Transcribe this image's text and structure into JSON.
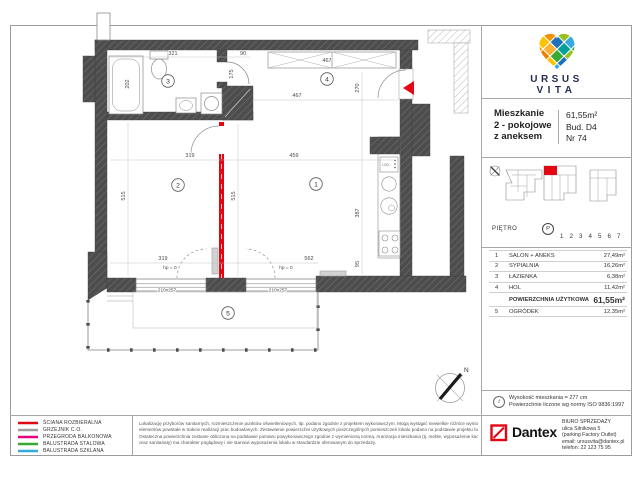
{
  "brand": {
    "line1": "URSUS",
    "line2": "VITA",
    "heart_warm": [
      "#f9b233",
      "#f39200",
      "#ef7d00",
      "#fdc300"
    ],
    "heart_cool": [
      "#95c11f",
      "#3aaa35",
      "#00a19a",
      "#36a9e1",
      "#1d71b8"
    ]
  },
  "header": {
    "title1": "Mieszkanie",
    "title2": "2 - pokojowe",
    "title3": "z aneksem",
    "area": "61,55m²",
    "building": "Bud. D4",
    "number": "Nr 74"
  },
  "floor_selector": {
    "label": "PIĘTRO",
    "selected": "P",
    "floors": [
      "1",
      "2",
      "3",
      "4",
      "5",
      "6",
      "7"
    ]
  },
  "rooms": [
    {
      "no": "1",
      "name": "SALON + ANEKS",
      "area": "27,49m²"
    },
    {
      "no": "2",
      "name": "SYPIALNIA",
      "area": "16,26m²"
    },
    {
      "no": "3",
      "name": "ŁAZIENKA",
      "area": "6,38m²"
    },
    {
      "no": "4",
      "name": "HOL",
      "area": "11,42m²"
    }
  ],
  "total": {
    "label": "POWIERZCHNIA UŻYTKOWA",
    "value": "61,55m²"
  },
  "extra_room": {
    "no": "5",
    "name": "OGRÓDEK",
    "area": "12,35m²"
  },
  "notes": {
    "line1": "Wysokość mieszkania = 277 cm",
    "line2": "Powierzchnie liczone wg normy ISO 9836:1997"
  },
  "legend": [
    {
      "label": "ŚCIANA ROZBIERALNA",
      "color": "#e30613"
    },
    {
      "label": "GRZEJNIK C.O.",
      "color": "#9d9d9c"
    },
    {
      "label": "PRZEGRODA BALKONOWA",
      "color": "#e6007e"
    },
    {
      "label": "BALUSTRADA STALOWA",
      "color": "#3aaa35"
    },
    {
      "label": "BALUSTRADA SZKLANA",
      "color": "#36a9e1"
    }
  ],
  "disclaimer": [
    "Lokalizację przyborów sanitarnych, rozmieszczenie punktów oświetleniowych, itp. podano zgodnie z projektem wykonawczym. Mogą wystąpić niewielkie różnice wymiarów i usytuowania",
    "elementów powstałe w trakcie realizacji prac budowlanych. Zestawienie powierzchni użytkowych poszczególnych pomieszczeń lokalu podano na podstawie projektu budowlanego.",
    "Ostateczna powierzchnia zostanie obliczona na podstawie pomiaru powykonawczego zgodnie z wymienioną normą. Aranżacja mieszkania (tj. meble, wyposażenie kuchni i łazienek",
    "oraz sanitariaty) ma charakter poglądowy i nie stanowi wyposażenia lokalu w standardzie oferowanym do sprzedaży."
  ],
  "dantex": {
    "name": "Dantex",
    "office": [
      "BIURO SPRZEDAŻY",
      "ulica Silnikowa 5",
      "(parking Factory Outlet)",
      "email: ursusvita@dantex.pl",
      "telefon: 22 123 75 95"
    ]
  },
  "plan": {
    "dims": [
      "321",
      "90",
      "202",
      "175",
      "467",
      "467",
      "270",
      "319",
      "459",
      "515",
      "515",
      "387",
      "95",
      "319",
      "562"
    ],
    "hp_label": "hp = 0",
    "window_labels": [
      "210x257",
      "210x257"
    ],
    "room_markers": [
      "1",
      "2",
      "3",
      "4",
      "5"
    ],
    "compass_label": "N",
    "fridge_label": "LOD."
  },
  "colors": {
    "brand_navy": "#242e52",
    "wall": "#4d4d4d",
    "accent_red": "#e30613"
  }
}
